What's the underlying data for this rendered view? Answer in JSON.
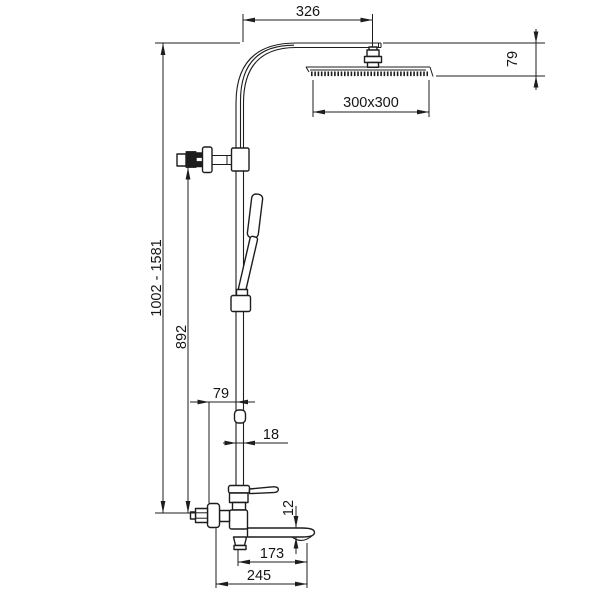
{
  "drawing": {
    "dimensions": {
      "arm_projection": "326",
      "head_height": "79",
      "head_size": "300x300",
      "total_height_range": "1002 - 1581",
      "riser_height": "892",
      "wall_to_riser": "79",
      "riser_diameter": "18",
      "spout_thickness": "12",
      "spout_projection": "173",
      "max_projection": "245"
    }
  }
}
